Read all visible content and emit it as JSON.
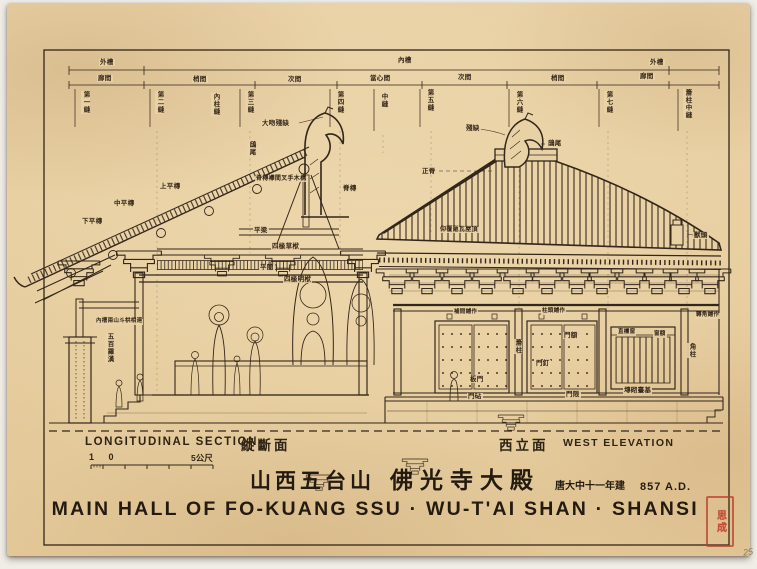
{
  "titles": {
    "chinese_location": "山西五台山",
    "chinese_name": "佛光寺大殿",
    "chinese_date": "唐大中十一年建",
    "date_western": "857 A.D.",
    "main_title_english": "MAIN HALL OF FO-KUANG SSU · WU-T'AI SHAN · SHANSI"
  },
  "captions": {
    "section_en": "LONGITUDINAL SECTION",
    "section_zh": "縱斷面",
    "elevation_zh": "西立面",
    "elevation_en": "WEST ELEVATION",
    "scale_left": "1 0",
    "scale_right": "5公尺",
    "seal_text": "思成",
    "page_number": "25"
  },
  "colors": {
    "paper": "#e8d1a4",
    "ink": "#33261a",
    "seal_red": "#be422e"
  },
  "annotations": [
    {
      "text": "外槽",
      "x": 92,
      "y": 56
    },
    {
      "text": "內槽",
      "x": 390,
      "y": 54
    },
    {
      "text": "外槽",
      "x": 642,
      "y": 56
    },
    {
      "text": "廊間",
      "x": 90,
      "y": 72
    },
    {
      "text": "梢間",
      "x": 185,
      "y": 73
    },
    {
      "text": "次間",
      "x": 280,
      "y": 73
    },
    {
      "text": "當心間",
      "x": 362,
      "y": 72
    },
    {
      "text": "次間",
      "x": 450,
      "y": 71
    },
    {
      "text": "梢間",
      "x": 543,
      "y": 72
    },
    {
      "text": "廊間",
      "x": 632,
      "y": 70
    },
    {
      "text": "第一縫",
      "x": 74,
      "y": 88,
      "v": true
    },
    {
      "text": "第二縫",
      "x": 148,
      "y": 88,
      "v": true
    },
    {
      "text": "內柱縫",
      "x": 204,
      "y": 90,
      "v": true
    },
    {
      "text": "第三縫",
      "x": 238,
      "y": 88,
      "v": true
    },
    {
      "text": "第四縫",
      "x": 328,
      "y": 88,
      "v": true
    },
    {
      "text": "中縫",
      "x": 372,
      "y": 90,
      "v": true
    },
    {
      "text": "第五縫",
      "x": 418,
      "y": 86,
      "v": true
    },
    {
      "text": "第六縫",
      "x": 507,
      "y": 88,
      "v": true
    },
    {
      "text": "第七縫",
      "x": 597,
      "y": 88,
      "v": true
    },
    {
      "text": "簷柱中縫",
      "x": 676,
      "y": 86,
      "v": true
    },
    {
      "text": "大吻殘缺",
      "x": 254,
      "y": 117
    },
    {
      "text": "鴟尾",
      "x": 240,
      "y": 138,
      "v": true
    },
    {
      "text": "脊槫襻間叉手木構",
      "x": 248,
      "y": 173,
      "fs": 6
    },
    {
      "text": "脊槫",
      "x": 335,
      "y": 182
    },
    {
      "text": "上平槫",
      "x": 152,
      "y": 180
    },
    {
      "text": "中平槫",
      "x": 106,
      "y": 197
    },
    {
      "text": "下平槫",
      "x": 74,
      "y": 215
    },
    {
      "text": "平梁",
      "x": 246,
      "y": 224
    },
    {
      "text": "四椽草栿",
      "x": 264,
      "y": 240
    },
    {
      "text": "平闇",
      "x": 252,
      "y": 261
    },
    {
      "text": "四椽明栿",
      "x": 276,
      "y": 273
    },
    {
      "text": "內槽兩山斗栱相連",
      "x": 88,
      "y": 316,
      "fs": 5.5
    },
    {
      "text": "五百羅漢",
      "x": 98,
      "y": 330,
      "v": true
    },
    {
      "text": "殘缺",
      "x": 458,
      "y": 122
    },
    {
      "text": "鴟尾",
      "x": 540,
      "y": 137
    },
    {
      "text": "正脊",
      "x": 414,
      "y": 165
    },
    {
      "text": "仰覆瓪瓦屋頂",
      "x": 432,
      "y": 224,
      "fs": 6
    },
    {
      "text": "獸頭",
      "x": 686,
      "y": 229
    },
    {
      "text": "轉角鋪作",
      "x": 688,
      "y": 310,
      "fs": 5.5
    },
    {
      "text": "補間鋪作",
      "x": 446,
      "y": 307,
      "fs": 5.5
    },
    {
      "text": "柱頭鋪作",
      "x": 534,
      "y": 306,
      "fs": 5.5
    },
    {
      "text": "門額",
      "x": 556,
      "y": 329
    },
    {
      "text": "簷柱",
      "x": 506,
      "y": 336,
      "v": true
    },
    {
      "text": "門釘",
      "x": 528,
      "y": 357
    },
    {
      "text": "板門",
      "x": 462,
      "y": 373
    },
    {
      "text": "門砧",
      "x": 460,
      "y": 390
    },
    {
      "text": "門限",
      "x": 558,
      "y": 388
    },
    {
      "text": "直欞窗",
      "x": 610,
      "y": 327,
      "fs": 5.5
    },
    {
      "text": "窗額",
      "x": 646,
      "y": 329,
      "fs": 5.5
    },
    {
      "text": "角柱",
      "x": 680,
      "y": 340,
      "v": true
    },
    {
      "text": "塼砌臺基",
      "x": 616,
      "y": 384
    }
  ]
}
